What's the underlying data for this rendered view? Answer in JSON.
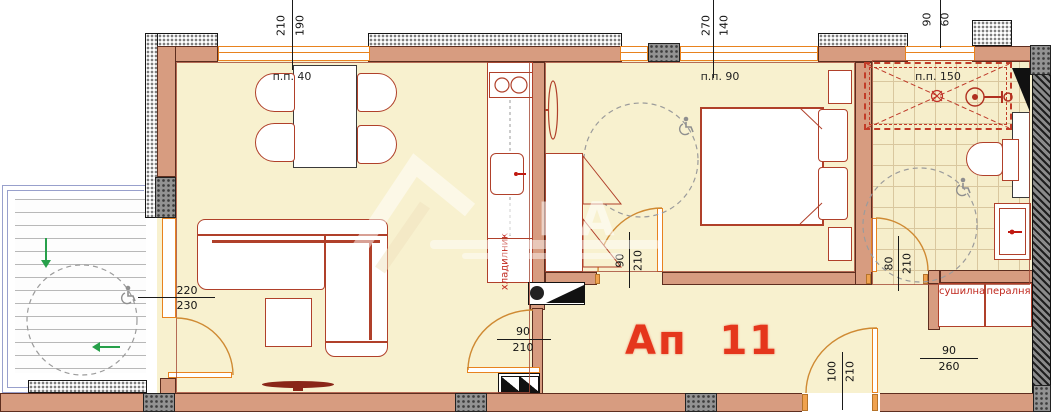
{
  "plan": {
    "apartment_label": "Ап  11",
    "watermark": "ЕРА",
    "rooms": {
      "living_window_label": "п.п. 40",
      "bedroom_window_label": "п.п. 90",
      "bath_window_label": "п.п. 150"
    },
    "appliances": {
      "fridge": "хладилник",
      "dryer": "сушилна",
      "washer": "пералня"
    },
    "dimensions": {
      "living_window": {
        "w": "210",
        "h": "190"
      },
      "bedroom_window": {
        "w": "270",
        "h": "140"
      },
      "bath_window": {
        "w": "90",
        "h": "60"
      },
      "balcony_door": {
        "w": "220",
        "h": "230"
      },
      "living_door": {
        "w": "90",
        "h": "210"
      },
      "bedroom_door": {
        "w": "90",
        "h": "210"
      },
      "bath_door": {
        "w": "80",
        "h": "210"
      },
      "entry_door": {
        "w": "100",
        "h": "210"
      },
      "utility_window": {
        "w": "90",
        "h": "260"
      }
    },
    "colors": {
      "wall": "#d79c80",
      "floor": "#f8f1cf",
      "accent_red": "#b0402a",
      "window_orange": "#e8821e",
      "label_red": "#c0281e",
      "title_red": "#e5361c"
    }
  }
}
